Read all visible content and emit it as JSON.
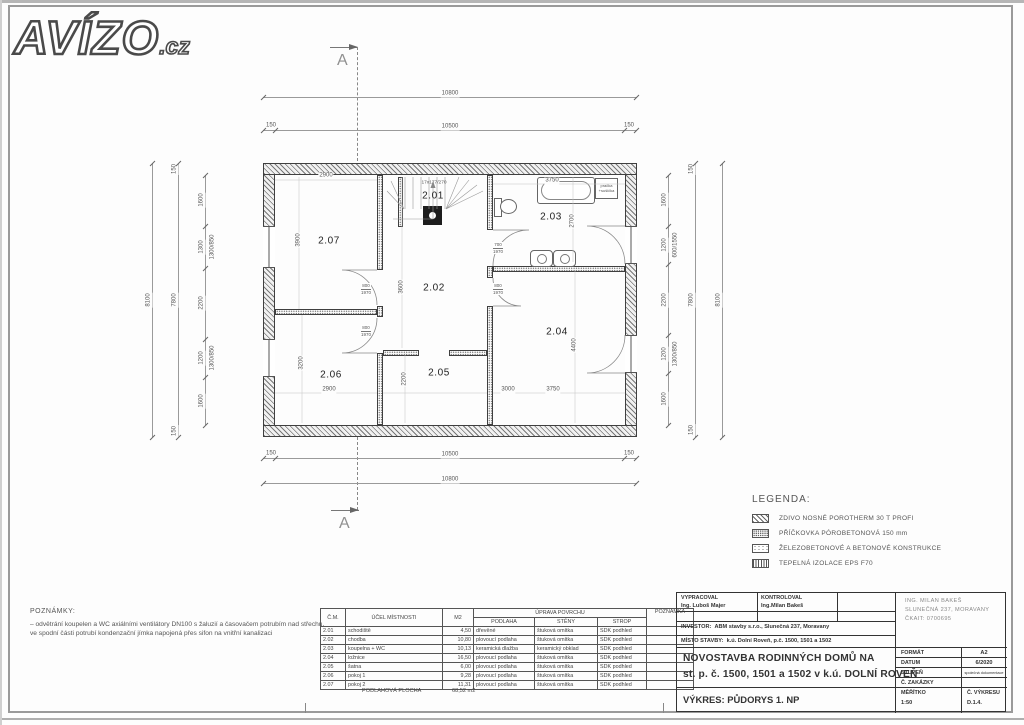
{
  "logo": {
    "text": "AVÍZO",
    "suffix": ".cz"
  },
  "section_marks": {
    "top": "A",
    "bottom": "A"
  },
  "plan": {
    "rooms": [
      {
        "id": "2.01"
      },
      {
        "id": "2.02"
      },
      {
        "id": "2.03"
      },
      {
        "id": "2.04"
      },
      {
        "id": "2.05"
      },
      {
        "id": "2.06"
      },
      {
        "id": "2.07"
      }
    ],
    "stair_label": "17x177/270",
    "washer": {
      "line1": "pračka",
      "line2": "+sušička"
    },
    "doors": [
      {
        "w": "800",
        "h": "1970"
      },
      {
        "w": "800",
        "h": "1970"
      },
      {
        "w": "700",
        "h": "1970"
      },
      {
        "w": "800",
        "h": "1970"
      }
    ]
  },
  "dims": {
    "top_overall": "10800",
    "top_off_l": "150",
    "top_inner": "10500",
    "top_off_r": "150",
    "bot_off_l": "150",
    "bot_inner": "10500",
    "bot_off_r": "150",
    "bot_overall": "10800",
    "left_overall": "8100",
    "left_off_t": "150",
    "left_inner": "7800",
    "left_off_b": "150",
    "left_seg1": "1600",
    "left_seg2": "1300",
    "left_seg3": "2200",
    "left_seg4": "1200",
    "left_seg5": "1600",
    "left_win1": "1300/850",
    "left_win2": "1300/850",
    "right_seg1": "1600",
    "right_seg2": "1200",
    "right_seg3": "2200",
    "right_seg4": "1200",
    "right_seg5": "1600",
    "right_win1": "600/1550",
    "right_win2": "1300/850",
    "right_off_t": "150",
    "right_inner": "7800",
    "right_off_b": "150",
    "right_overall": "8100",
    "r207_w": "2900",
    "r207_h": "3900",
    "r206_h": "3200",
    "r206_w": "2900",
    "r202_h": "3600",
    "r205_h": "2200",
    "r205_w": "3000",
    "r204_w": "3750",
    "r204_h": "4400",
    "r203_w": "3750",
    "r203_h": "2700"
  },
  "legend": {
    "title": "LEGENDA:",
    "items": [
      {
        "label": "ZDIVO NOSNÉ POROTHERM 30 T PROFI"
      },
      {
        "label": "PŘÍČKOVKA PÓROBETONOVÁ 150 mm"
      },
      {
        "label": "ŽELEZOBETONOVÉ A BETONOVÉ KONSTRUKCE"
      },
      {
        "label": "TEPELNÁ IZOLACE EPS F70"
      }
    ]
  },
  "notes": {
    "title": "POZNÁMKY:",
    "body": "–  odvětrání koupelen a WC axiálními ventilátory DN100 s žaluzií a časovačem potrubím nad střechu, ve spodní části potrubí kondenzační jímka napojená přes sifon na vnitřní kanalizaci"
  },
  "room_table": {
    "headers": {
      "cm": "Č.M.",
      "purpose": "ÚČEL MÍSTNOSTI",
      "m2": "M2",
      "surface": "ÚPRAVA POVRCHU",
      "floor": "PODLAHA",
      "walls": "STĚNY",
      "ceiling": "STROP",
      "note": "POZNÁMKA"
    },
    "rows": [
      [
        "2.01",
        "schodiště",
        "4,50",
        "dřevěné",
        "štuková omítka",
        "SDK podhled",
        ""
      ],
      [
        "2.02",
        "chodba",
        "10,80",
        "plovoucí podlaha",
        "štuková omítka",
        "SDK podhled",
        ""
      ],
      [
        "2.03",
        "koupelna + WC",
        "10,13",
        "keramická dlažba",
        "keramický obklad",
        "SDK podhled",
        ""
      ],
      [
        "2.04",
        "ložnice",
        "16,50",
        "plovoucí podlaha",
        "štuková omítka",
        "SDK podhled",
        ""
      ],
      [
        "2.05",
        "šatna",
        "6,00",
        "plovoucí podlaha",
        "štuková omítka",
        "SDK podhled",
        ""
      ],
      [
        "2.06",
        "pokoj 1",
        "9,28",
        "plovoucí podlaha",
        "štuková omítka",
        "SDK podhled",
        ""
      ],
      [
        "2.07",
        "pokoj 2",
        "11,31",
        "plovoucí podlaha",
        "štuková omítka",
        "SDK podhled",
        ""
      ]
    ],
    "footer_label": "PODLAHOVÁ PLOCHA",
    "footer_value": "68,52 m2"
  },
  "title_block": {
    "vypracoval_label": "VYPRACOVAL",
    "vypracoval": "Ing. Luboš Majer",
    "kontroloval_label": "KONTROLOVAL",
    "kontroloval": "Ing.Milan Bakeš",
    "stamp1": "ING. MILAN BAKEŠ",
    "stamp2": "SLUNEČNÁ 237, MORAVANY",
    "stamp3": "ČKAIT: 0700695",
    "investor_label": "INVESTOR:",
    "investor": "ABM stavby s.r.o., Slunečná 237, Moravany",
    "misto_label": "MÍSTO STAVBY:",
    "misto": "k.ú. Dolní Roveň, p.č. 1500, 1501 a 1502",
    "title1": "NOVOSTAVBA RODINNÝCH DOMŮ NA",
    "title2": "st. p. č. 1500, 1501 a 1502 v k.ú. DOLNÍ ROVEŇ",
    "format_label": "FORMÁT",
    "format": "A2",
    "datum_label": "DATUM",
    "datum": "6/2020",
    "stupen_label": "STUPEŇ",
    "stupen": "společná dokumentace",
    "zakazka_label": "Č. ZAKÁZKY",
    "zakazka": "",
    "meritko_label": "MĚŘÍTKO",
    "meritko": "1:50",
    "cvykresu_label": "Č. VÝKRESU",
    "cvykresu": "D.1.4.",
    "vykres": "VÝKRES: PŮDORYS 1. NP"
  }
}
